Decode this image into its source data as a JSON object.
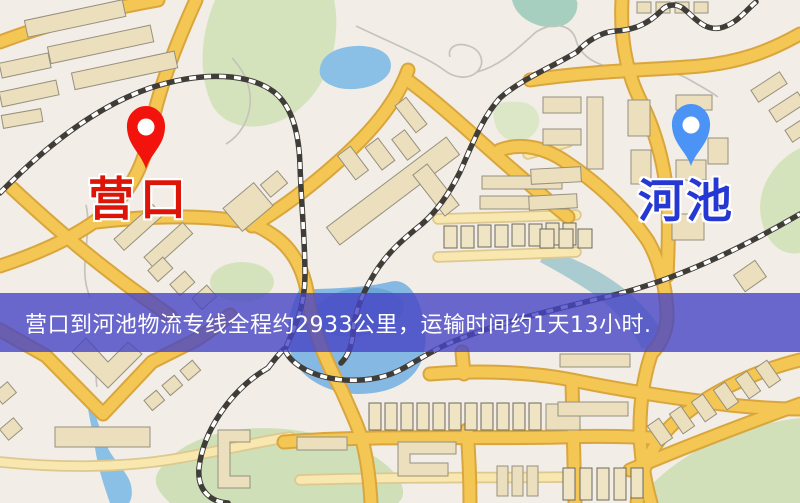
{
  "route": {
    "origin": {
      "label": "营口"
    },
    "destination": {
      "label": "河池"
    },
    "banner": {
      "text": "营口到河池物流专线全程约2933公里，运输时间约1天13小时."
    }
  },
  "icons": {
    "origin_pin": "red-map-pin",
    "destination_pin": "blue-map-pin"
  },
  "colors": {
    "background": "#f2eee7",
    "park": "#d5e3bd",
    "park_teal": "#a6cfc0",
    "water": "#8bc0e6",
    "road_major": "#f4c654",
    "road_major_casing": "#d9a63e",
    "road_minor": "#f8e7ae",
    "road_minor_casing": "#ddc88f",
    "railway": "#403c37",
    "building": "#ebdfbe",
    "banner_bg": "rgba(70,69,196,0.8)",
    "banner_text": "#ffffff",
    "origin_pin": "#f2140c",
    "origin_label": "#dd1509",
    "destination_pin": "#4b94f5",
    "destination_label": "#2638d4"
  }
}
